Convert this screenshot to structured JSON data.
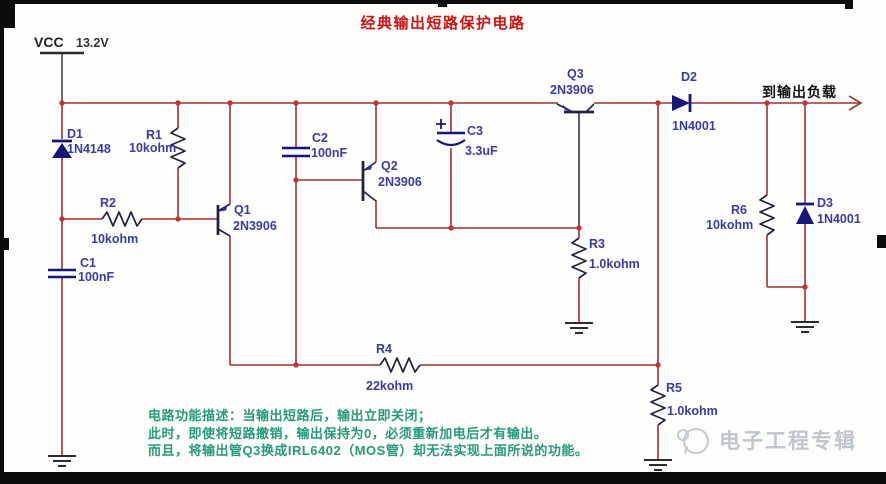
{
  "title": "经典输出短路保护电路",
  "power": {
    "net": "VCC",
    "voltage": "13.2V"
  },
  "output_label": "到输出负载",
  "components": {
    "d1": {
      "ref": "D1",
      "value": "1N4148"
    },
    "d2": {
      "ref": "D2",
      "value": "1N4001"
    },
    "d3": {
      "ref": "D3",
      "value": "1N4001"
    },
    "r1": {
      "ref": "R1",
      "value": "10kohm"
    },
    "r2": {
      "ref": "R2",
      "value": "10kohm"
    },
    "r3": {
      "ref": "R3",
      "value": "1.0kohm"
    },
    "r4": {
      "ref": "R4",
      "value": "22kohm"
    },
    "r5": {
      "ref": "R5",
      "value": "1.0kohm"
    },
    "r6": {
      "ref": "R6",
      "value": "10kohm"
    },
    "c1": {
      "ref": "C1",
      "value": "100nF"
    },
    "c2": {
      "ref": "C2",
      "value": "100nF"
    },
    "c3": {
      "ref": "C3",
      "value": "3.3uF",
      "polarity": "+"
    },
    "q1": {
      "ref": "Q1",
      "value": "2N3906"
    },
    "q2": {
      "ref": "Q2",
      "value": "2N3906"
    },
    "q3": {
      "ref": "Q3",
      "value": "2N3906"
    }
  },
  "description": {
    "line1": "电路功能描述：当输出短路后，输出立即关闭；",
    "line2": "此时，即使将短路撤销，输出保持为0，必须重新加电后才有输出。",
    "line3": "而且，将输出管Q3换成IRL6402（MOS管）却无法实现上面所说的功能。"
  },
  "watermark": {
    "text": "电子工程专辑"
  },
  "colors": {
    "wire": "#9d3332",
    "junction": "#c03434",
    "symbol": "#23233f",
    "diode": "#15157a",
    "label": "#3b3ba6",
    "title": "#cf1212",
    "description": "#27997b",
    "watermark": "#bfc5cc",
    "frame": "#0c0c0c"
  }
}
